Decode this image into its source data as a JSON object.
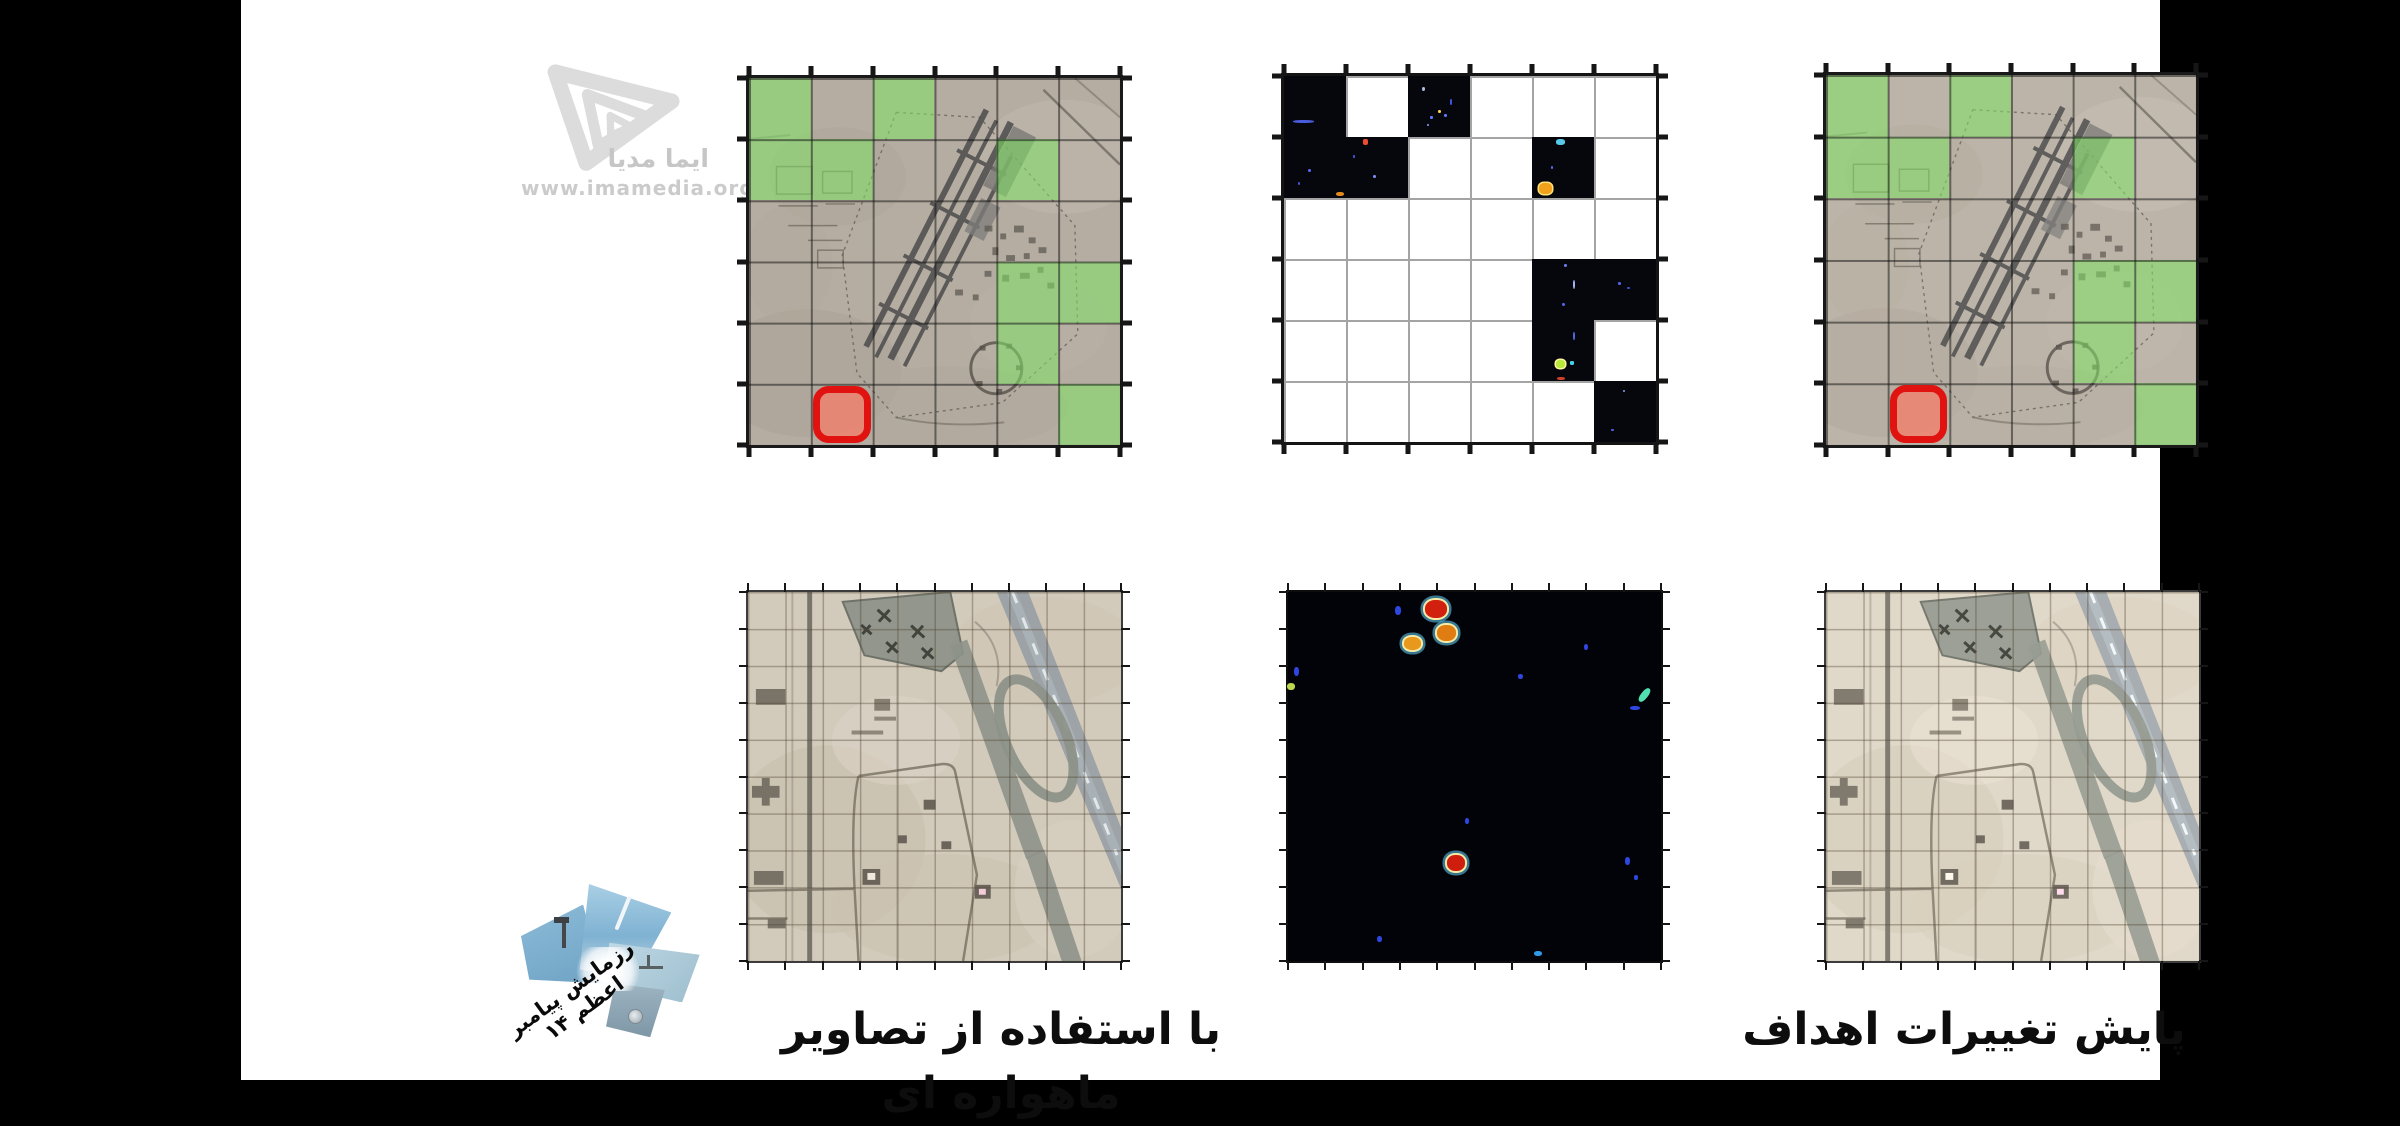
{
  "watermark": {
    "brand": "ایما مدیا",
    "url": "www.imamedia.org"
  },
  "captions": {
    "left": "با استفاده از تصاویر ماهواره ای",
    "right": "پایش تغییرات اهداف"
  },
  "badge": {
    "title": "رزمایش پیامبر اعظم ۱۴"
  },
  "analysis": {
    "grid": {
      "rows": 6,
      "cols": 6
    },
    "changed_cells": [
      [
        0,
        0
      ],
      [
        0,
        2
      ],
      [
        1,
        0
      ],
      [
        1,
        1
      ],
      [
        1,
        4
      ],
      [
        3,
        4
      ],
      [
        3,
        5
      ],
      [
        4,
        4
      ],
      [
        5,
        5
      ]
    ],
    "marked_cell": [
      5,
      1
    ],
    "colors": {
      "change_overlay": "rgba(128,226,100,0.55)",
      "mask_cell": "#05070d",
      "mark_border": "#e01311",
      "mark_fill": "rgba(249,124,102,0.72)"
    },
    "cell_specks": {
      "0,0": [
        {
          "x": 15,
          "y": 72,
          "w": 34,
          "h": 5,
          "c": "#4a5cde"
        }
      ],
      "0,2": [
        {
          "x": 22,
          "y": 18,
          "w": 6,
          "h": 7,
          "c": "#aabbdd"
        },
        {
          "x": 48,
          "y": 55,
          "w": 5,
          "h": 6,
          "c": "#ffd357"
        },
        {
          "x": 58,
          "y": 62,
          "w": 5,
          "h": 5,
          "c": "#5f7bff"
        },
        {
          "x": 36,
          "y": 66,
          "w": 4,
          "h": 5,
          "c": "#5f7bff"
        },
        {
          "x": 68,
          "y": 38,
          "w": 3,
          "h": 9,
          "c": "#3d55e2"
        },
        {
          "x": 30,
          "y": 78,
          "w": 4,
          "h": 4,
          "c": "#8fa3ff"
        }
      ],
      "1,0": [
        {
          "x": 38,
          "y": 52,
          "w": 5,
          "h": 6,
          "c": "#5668f0"
        },
        {
          "x": 22,
          "y": 74,
          "w": 4,
          "h": 4,
          "c": "#4456d8"
        },
        {
          "x": 84,
          "y": 90,
          "w": 13,
          "h": 7,
          "c": "#e2891c"
        }
      ],
      "1,1": [
        {
          "x": 28,
          "y": 4,
          "w": 7,
          "h": 9,
          "c": "#ef4b2e"
        },
        {
          "x": 44,
          "y": 62,
          "w": 5,
          "h": 6,
          "c": "#7d8cf2"
        },
        {
          "x": 12,
          "y": 30,
          "w": 3,
          "h": 4,
          "c": "#4456d8"
        }
      ],
      "1,4": [
        {
          "x": 38,
          "y": 4,
          "w": 16,
          "h": 9,
          "c": "#58c9e8"
        },
        {
          "x": 30,
          "y": 48,
          "w": 4,
          "h": 4,
          "c": "#5668f0"
        },
        {
          "x": 12,
          "y": 76,
          "w": 20,
          "h": 18,
          "c": "#f2a21a",
          "glow": "#ffe27a"
        }
      ],
      "3,4": [
        {
          "x": 52,
          "y": 8,
          "w": 5,
          "h": 5,
          "c": "#6a7bf0"
        },
        {
          "x": 66,
          "y": 34,
          "w": 4,
          "h": 16,
          "c": "#aab6f4"
        },
        {
          "x": 48,
          "y": 72,
          "w": 5,
          "h": 5,
          "c": "#5163e8"
        }
      ],
      "3,5": [
        {
          "x": 38,
          "y": 38,
          "w": 5,
          "h": 4,
          "c": "#5163e8"
        },
        {
          "x": 54,
          "y": 46,
          "w": 4,
          "h": 4,
          "c": "#3d4fd2"
        }
      ],
      "4,4": [
        {
          "x": 38,
          "y": 66,
          "w": 15,
          "h": 13,
          "c": "#b8e83c",
          "glow": "#fff7a0"
        },
        {
          "x": 62,
          "y": 68,
          "w": 5,
          "h": 5,
          "c": "#3fd4e8"
        },
        {
          "x": 40,
          "y": 94,
          "w": 13,
          "h": 5,
          "c": "#d2402a"
        },
        {
          "x": 66,
          "y": 20,
          "w": 3,
          "h": 12,
          "c": "#5565e0"
        }
      ],
      "5,5": [
        {
          "x": 46,
          "y": 14,
          "w": 4,
          "h": 4,
          "c": "#8f9ff2"
        },
        {
          "x": 28,
          "y": 78,
          "w": 4,
          "h": 4,
          "c": "#5565e0"
        }
      ]
    },
    "heat_spots": [
      {
        "x": 39.8,
        "y": 4.5,
        "w": 22,
        "h": 18,
        "c": "#d2200f",
        "ring": true
      },
      {
        "x": 42.5,
        "y": 11,
        "w": 19,
        "h": 16,
        "c": "#e07d12",
        "ring": true
      },
      {
        "x": 33.5,
        "y": 14,
        "w": 17,
        "h": 13,
        "c": "#e8981c",
        "ring": true
      },
      {
        "x": 45,
        "y": 73.5,
        "w": 18,
        "h": 16,
        "c": "#cf1e0e",
        "ring": true
      },
      {
        "x": 29.5,
        "y": 5,
        "w": 6,
        "h": 9,
        "c": "#2e47e0"
      },
      {
        "x": 2.2,
        "y": 21.5,
        "w": 5,
        "h": 9,
        "c": "#2e47e0"
      },
      {
        "x": 0.8,
        "y": 25.5,
        "w": 8,
        "h": 7,
        "c": "#bcd94e"
      },
      {
        "x": 62.3,
        "y": 23,
        "w": 5,
        "h": 5,
        "c": "#2e47e0"
      },
      {
        "x": 80,
        "y": 15,
        "w": 4,
        "h": 6,
        "c": "#2e47e0"
      },
      {
        "x": 95.5,
        "y": 28,
        "w": 7,
        "h": 16,
        "c": "#52e0b0",
        "rot": 38
      },
      {
        "x": 93,
        "y": 31.5,
        "w": 10,
        "h": 4,
        "c": "#2e47e0"
      },
      {
        "x": 48,
        "y": 62,
        "w": 4,
        "h": 6,
        "c": "#2e47e0"
      },
      {
        "x": 91,
        "y": 73,
        "w": 5,
        "h": 8,
        "c": "#2e47e0"
      },
      {
        "x": 93.4,
        "y": 77.5,
        "w": 4,
        "h": 5,
        "c": "#2e47e0"
      },
      {
        "x": 24.5,
        "y": 94,
        "w": 5,
        "h": 6,
        "c": "#2e47e0"
      },
      {
        "x": 67,
        "y": 98,
        "w": 8,
        "h": 5,
        "c": "#2e9ae8"
      }
    ]
  }
}
